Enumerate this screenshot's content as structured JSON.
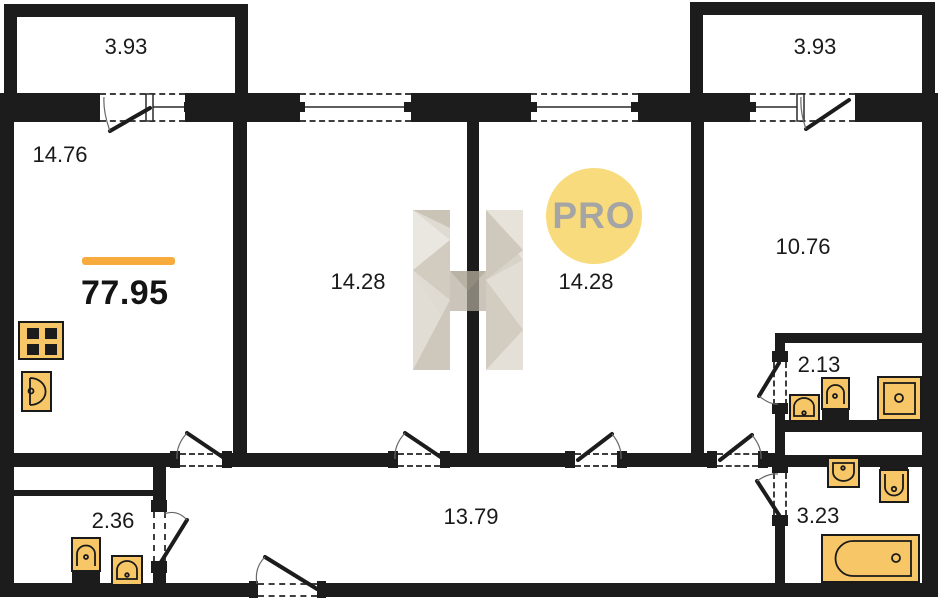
{
  "colors": {
    "wall": "#1c1c1c",
    "accent-orange": "#F8AB3D",
    "fixture-fill": "#F7C767",
    "badge-bg": "#F8DB7D",
    "badge-text": "#A5A5A5",
    "label-text": "#1a1a1a"
  },
  "badge": {
    "label": "PRO"
  },
  "total": {
    "area": "77.95"
  },
  "rooms": {
    "balcony_left": {
      "area": "3.93"
    },
    "balcony_right": {
      "area": "3.93"
    },
    "living": {
      "area": "14.76"
    },
    "bedroom_left": {
      "area": "14.28"
    },
    "bedroom_right": {
      "area": "14.28"
    },
    "bedroom_small": {
      "area": "10.76"
    },
    "bathroom_top": {
      "area": "2.13"
    },
    "bathroom_bottom": {
      "area": "3.23"
    },
    "wc": {
      "area": "2.36"
    },
    "hallway": {
      "area": "13.79"
    }
  },
  "fixtures": [
    "stove-icon",
    "kitchen-sink-icon",
    "sink-icon",
    "toilet-icon",
    "shower-tray-icon",
    "bathtub-icon"
  ],
  "watermark": {
    "icon": "h-logo"
  }
}
